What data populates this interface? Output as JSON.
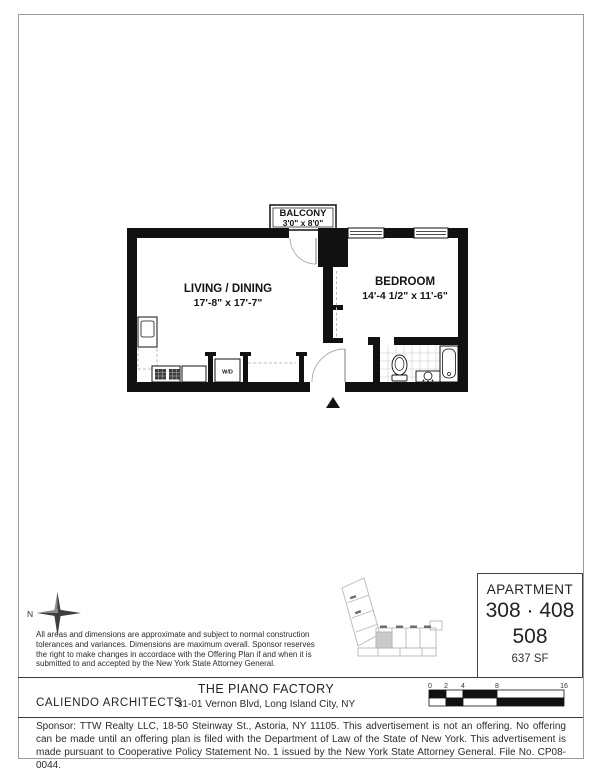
{
  "colors": {
    "wall": "#111111",
    "page_border": "#9b9b9b",
    "key_map_line": "#b8b8b8"
  },
  "floor_plan": {
    "balcony_label": "BALCONY",
    "balcony_dims": "3'0\" x 8'0\"",
    "living_label": "LIVING / DINING",
    "living_dims": "17'-8\" x 17'-7\"",
    "bedroom_label": "BEDROOM",
    "bedroom_dims": "14'-4 1/2\" x 11'-6\"",
    "wd_label": "W/D"
  },
  "compass": {
    "north": "N"
  },
  "disclaimer": {
    "lines": [
      "All areas and dimensions are approximate and subject to normal construction",
      "tolerances and variances. Dimensions are maximum overall. Sponsor reserves",
      "the right to make changes in accordace with the Offering Plan if and when it is",
      "submitted to and accepted by the New York State Attorney General."
    ]
  },
  "apartment_box": {
    "heading": "APARTMENT",
    "units_line1": "308 · 408",
    "units_line2": "508",
    "area": "637 SF"
  },
  "footer": {
    "architect": "CALIENDO ARCHITECTS",
    "building_name": "THE PIANO FACTORY",
    "address": "31-01 Vernon Blvd, Long Island City, NY",
    "scale_ticks": [
      "0",
      "2",
      "4",
      "8",
      "16"
    ]
  },
  "legal": "Sponsor: TTW Realty LLC, 18-50 Steinway St., Astoria, NY 11105. This advertisement is not an offering.  No offering can be made until an offering plan is filed with the Department of Law of the State of New York. This advertisement is made pursuant to Cooperative Policy Statement No. 1 issued by the New York State Attorney General.  File No. CP08-0044."
}
